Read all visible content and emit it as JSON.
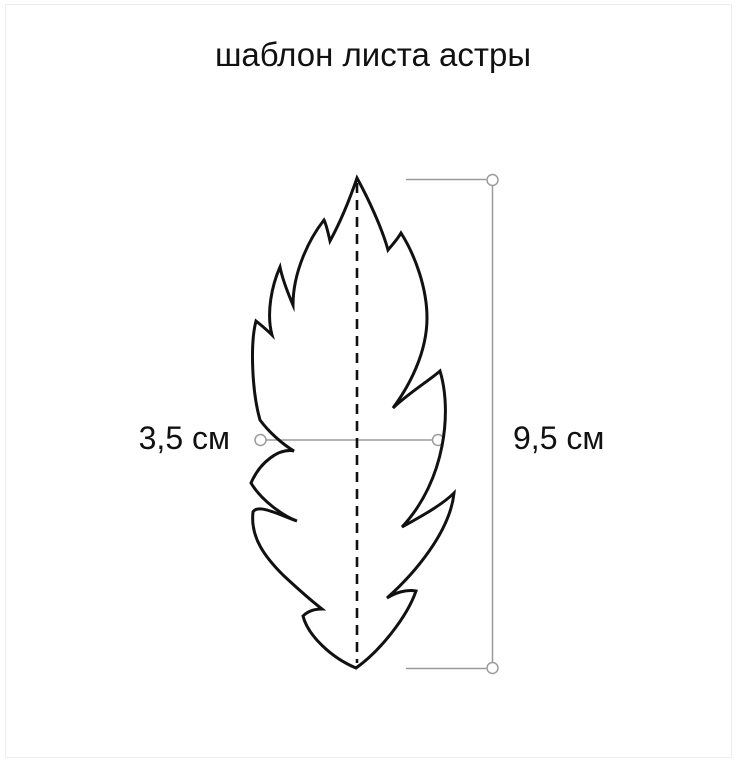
{
  "title": "шаблон листа астры",
  "measurements": {
    "width_label": "3,5 см",
    "height_label": "9,5 см"
  },
  "colors": {
    "background": "#ffffff",
    "leaf_outline": "#111111",
    "measure_line": "#9b9b9b",
    "text": "#111111"
  }
}
